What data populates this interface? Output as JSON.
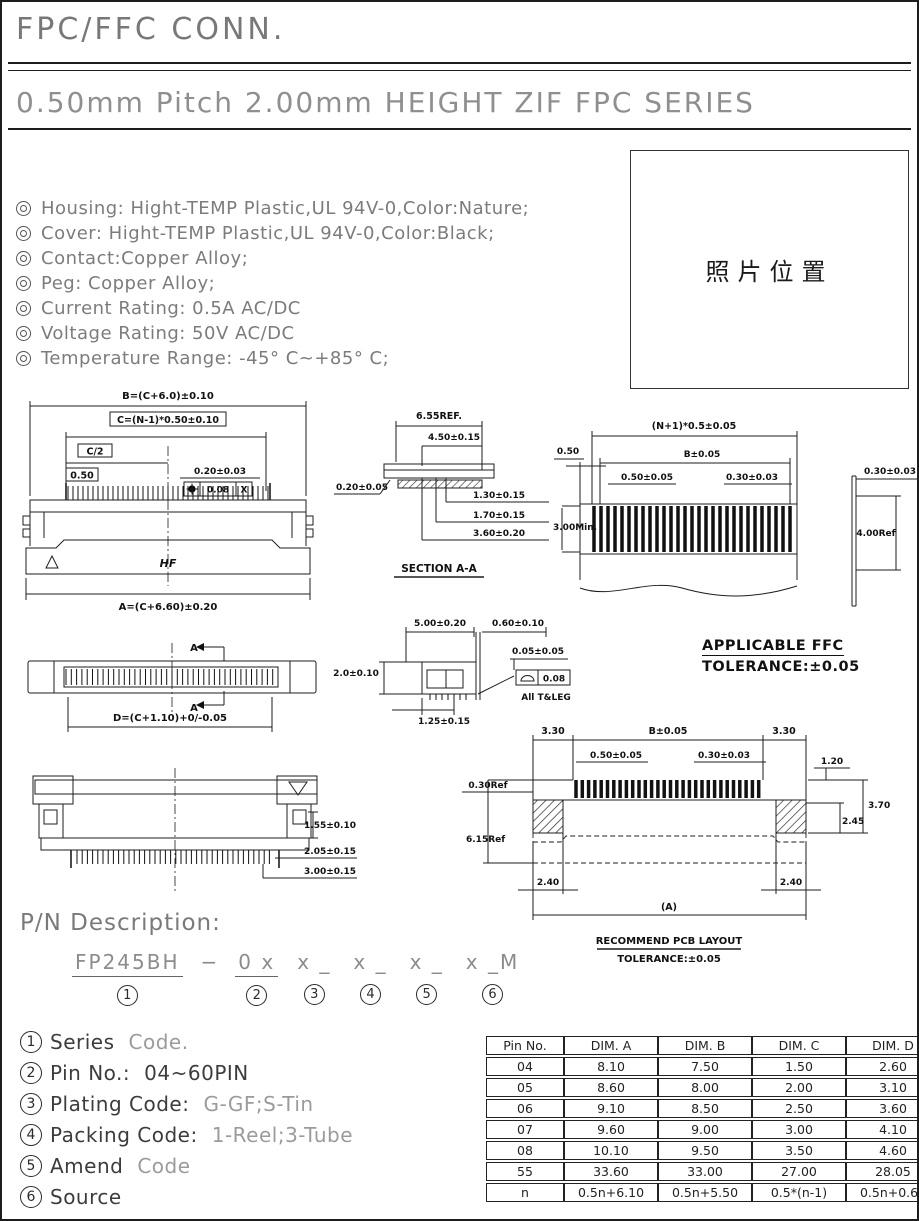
{
  "page": {
    "title": "FPC/FFC CONN.",
    "series_title": "0.50mm Pitch 2.00mm HEIGHT ZIF FPC SERIES"
  },
  "specs": [
    "Housing: Hight-TEMP Plastic,UL 94V-0,Color:Nature;",
    "Cover: Hight-TEMP Plastic,UL 94V-0,Color:Black;",
    "Contact:Copper Alloy;",
    "Peg: Copper Alloy;",
    "Current Rating: 0.5A AC/DC",
    "Voltage Rating: 50V AC/DC",
    "Temperature Range: -45° C~+85° C;"
  ],
  "photo_box": {
    "label": "照片位置"
  },
  "drawings": {
    "front_view": {
      "dim_b": "B=(C+6.0)±0.10",
      "dim_c": "C=(N-1)*0.50±0.10",
      "dim_c_half": "C/2",
      "dim_pitch": "0.50",
      "dim_pad": "0.20±0.03",
      "gdt_value": "0.08",
      "gdt_datum": "X",
      "brand": "HF",
      "dim_a": "A=(C+6.60)±0.20"
    },
    "section_aa": {
      "dim1": "6.55REF.",
      "dim2": "4.50±0.15",
      "dim3": "0.20±0.05",
      "dim4": "1.30±0.15",
      "dim5": "1.70±0.15",
      "dim6": "3.60±0.20",
      "caption": "SECTION A-A"
    },
    "ffc": {
      "dim1": "(N+1)*0.5±0.05",
      "dim2": "0.50",
      "dim3": "B±0.05",
      "dim4": "0.50±0.05",
      "dim5": "0.30±0.03",
      "dim6": "3.00Min.",
      "dim7": "0.30±0.03",
      "dim8": "4.00Ref",
      "caption1": "APPLICABLE FFC",
      "caption2": "TOLERANCE:±0.05"
    },
    "top_view": {
      "section_label": "A",
      "dim_d": "D=(C+1.10)+0/-0.05"
    },
    "side_view": {
      "dim1": "5.00±0.20",
      "dim2": "0.60±0.10",
      "dim3": "2.0±0.10",
      "dim4": "0.05±0.05",
      "gdt_value": "0.08",
      "gdt_note": "All T&LEG",
      "dim5": "1.25±0.15"
    },
    "rear_view": {
      "dim1": "1.55±0.10",
      "dim2": "2.05±0.15",
      "dim3": "3.00±0.15"
    },
    "pcb": {
      "dim_a1": "3.30",
      "dim_b": "B±0.05",
      "dim_a2": "3.30",
      "dim_c": "0.50±0.05",
      "dim_d": "0.30±0.03",
      "dim_e": "1.20",
      "dim_f": "0.30Ref",
      "dim_g": "3.70",
      "dim_h": "2.45",
      "dim_i": "6.15Ref",
      "dim_j": "2.40",
      "dim_k": "2.40",
      "dim_l": "(A)",
      "caption1": "RECOMMEND PCB LAYOUT",
      "caption2": "TOLERANCE:±0.05"
    }
  },
  "pn": {
    "heading": "P/N Description:",
    "dash": "−",
    "segments": [
      "FP245BH",
      "0 x",
      "x _",
      "x _",
      "x _",
      "x _M"
    ],
    "nums": [
      "1",
      "2",
      "3",
      "4",
      "5",
      "6"
    ]
  },
  "legend": [
    {
      "num": "1",
      "label": "Series",
      "value": "Code.",
      "muted": true
    },
    {
      "num": "2",
      "label": "Pin No.:",
      "value": "04~60PIN",
      "muted": false
    },
    {
      "num": "3",
      "label": "Plating Code:",
      "value": "G-GF;S-Tin",
      "muted": true
    },
    {
      "num": "4",
      "label": "Packing Code:",
      "value": "1-Reel;3-Tube",
      "muted": true
    },
    {
      "num": "5",
      "label": "Amend",
      "value": "Code",
      "muted": true
    },
    {
      "num": "6",
      "label": "Source",
      "value": "",
      "muted": false
    }
  ],
  "table": {
    "headers": [
      "Pin No.",
      "DIM. A",
      "DIM. B",
      "DIM. C",
      "DIM. D"
    ],
    "rows": [
      [
        "04",
        "8.10",
        "7.50",
        "1.50",
        "2.60"
      ],
      [
        "05",
        "8.60",
        "8.00",
        "2.00",
        "3.10"
      ],
      [
        "06",
        "9.10",
        "8.50",
        "2.50",
        "3.60"
      ],
      [
        "07",
        "9.60",
        "9.00",
        "3.00",
        "4.10"
      ],
      [
        "08",
        "10.10",
        "9.50",
        "3.50",
        "4.60"
      ],
      [
        "55",
        "33.60",
        "33.00",
        "27.00",
        "28.05"
      ],
      [
        "n",
        "0.5n+6.10",
        "0.5n+5.50",
        "0.5*(n-1)",
        "0.5n+0.60"
      ]
    ]
  },
  "colors": {
    "ink": "#1a1a1a",
    "soft_text": "#7c7c7c",
    "muted_text": "#9b9b9b",
    "paper": "#ffffff"
  }
}
